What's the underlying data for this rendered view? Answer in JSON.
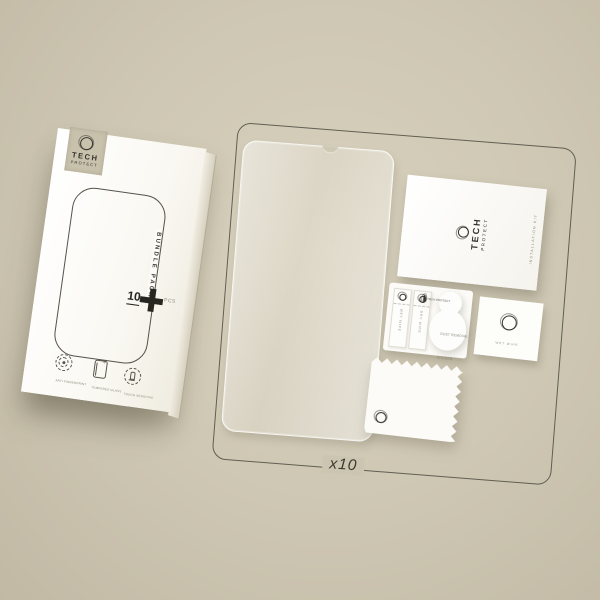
{
  "colors": {
    "background": "#cec7b3",
    "outline": "#4e4b42",
    "text_dark": "#3a382e",
    "badge": "#c8c1ac",
    "white": "#fcfbf7"
  },
  "box": {
    "badge": {
      "word1": "TECH",
      "word2": "PROTECT"
    },
    "bundle_label": "BUNDLE PACK",
    "qty": {
      "number": "10",
      "unit": "PCS"
    },
    "features": [
      {
        "icon": "fingerprint-icon",
        "label": "ANTI FINGERPRINT"
      },
      {
        "icon": "tempered-glass-icon",
        "label": "TEMPERED GLASS"
      },
      {
        "icon": "touch-sensitive-icon",
        "label": "TOUCH SENSITIVE"
      }
    ]
  },
  "kit": {
    "quantity_label": "x10",
    "card": {
      "word1": "TECH",
      "word2": "PROTECT",
      "edge_text": "INSTALLATION KIT"
    },
    "sachets": [
      {
        "label": "WET WIPE"
      },
      {
        "label": "DRY WIPE"
      }
    ],
    "dust_sticker": {
      "brand": "TECH PROTECT",
      "line1": "DUST REMOVAL",
      "line2": "STICKER"
    },
    "wet_wipe": {
      "label": "WET WIPE"
    }
  }
}
